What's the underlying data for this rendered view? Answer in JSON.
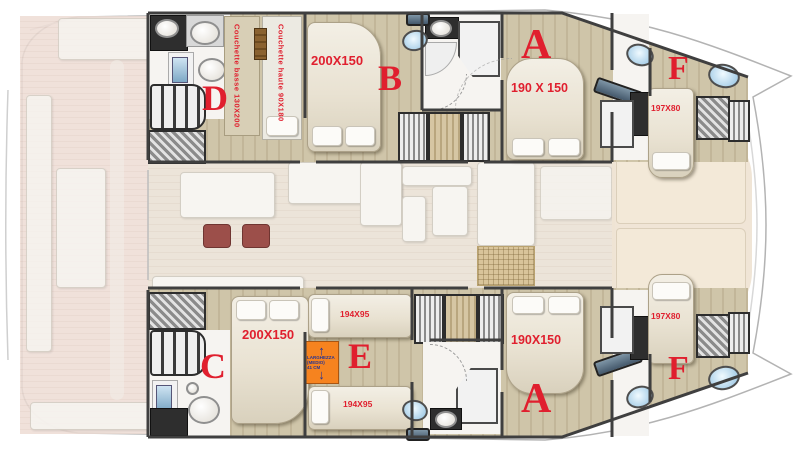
{
  "plan_title": "Catamaran 6-cabin layout",
  "cabins": {
    "d": {
      "label": "D",
      "berth_low": "Couchette basse 130X200",
      "berth_high": "Couchette haute 90X180"
    },
    "b": {
      "label": "B",
      "bed": "200X150"
    },
    "a_top": {
      "label": "A",
      "bed": "190 X 150"
    },
    "f_top": {
      "label": "F",
      "bed": "197X80"
    },
    "c": {
      "label": "C",
      "bed": "200X150"
    },
    "e": {
      "label": "E",
      "bed_fwd": "194X95",
      "bed_aft": "194X95"
    },
    "a_bottom": {
      "label": "A",
      "bed": "190X150"
    },
    "f_bottom": {
      "label": "F",
      "bed": "197X80"
    }
  },
  "annotation": {
    "line1": "LARGHEZZA",
    "line2": "(MEDIO)",
    "line3": "41 CM",
    "up_arrow": "↑",
    "down_arrow": "↓"
  },
  "colors": {
    "label_red": "#e01f2e",
    "wood_floor": "#cbc0a4",
    "faded_deck": "#ebdad2",
    "annotation_orange": "#f6831f",
    "arrow_blue": "#283593",
    "porthole_blue": "#bcdcf0",
    "wall_dark": "#3f3f3f"
  }
}
